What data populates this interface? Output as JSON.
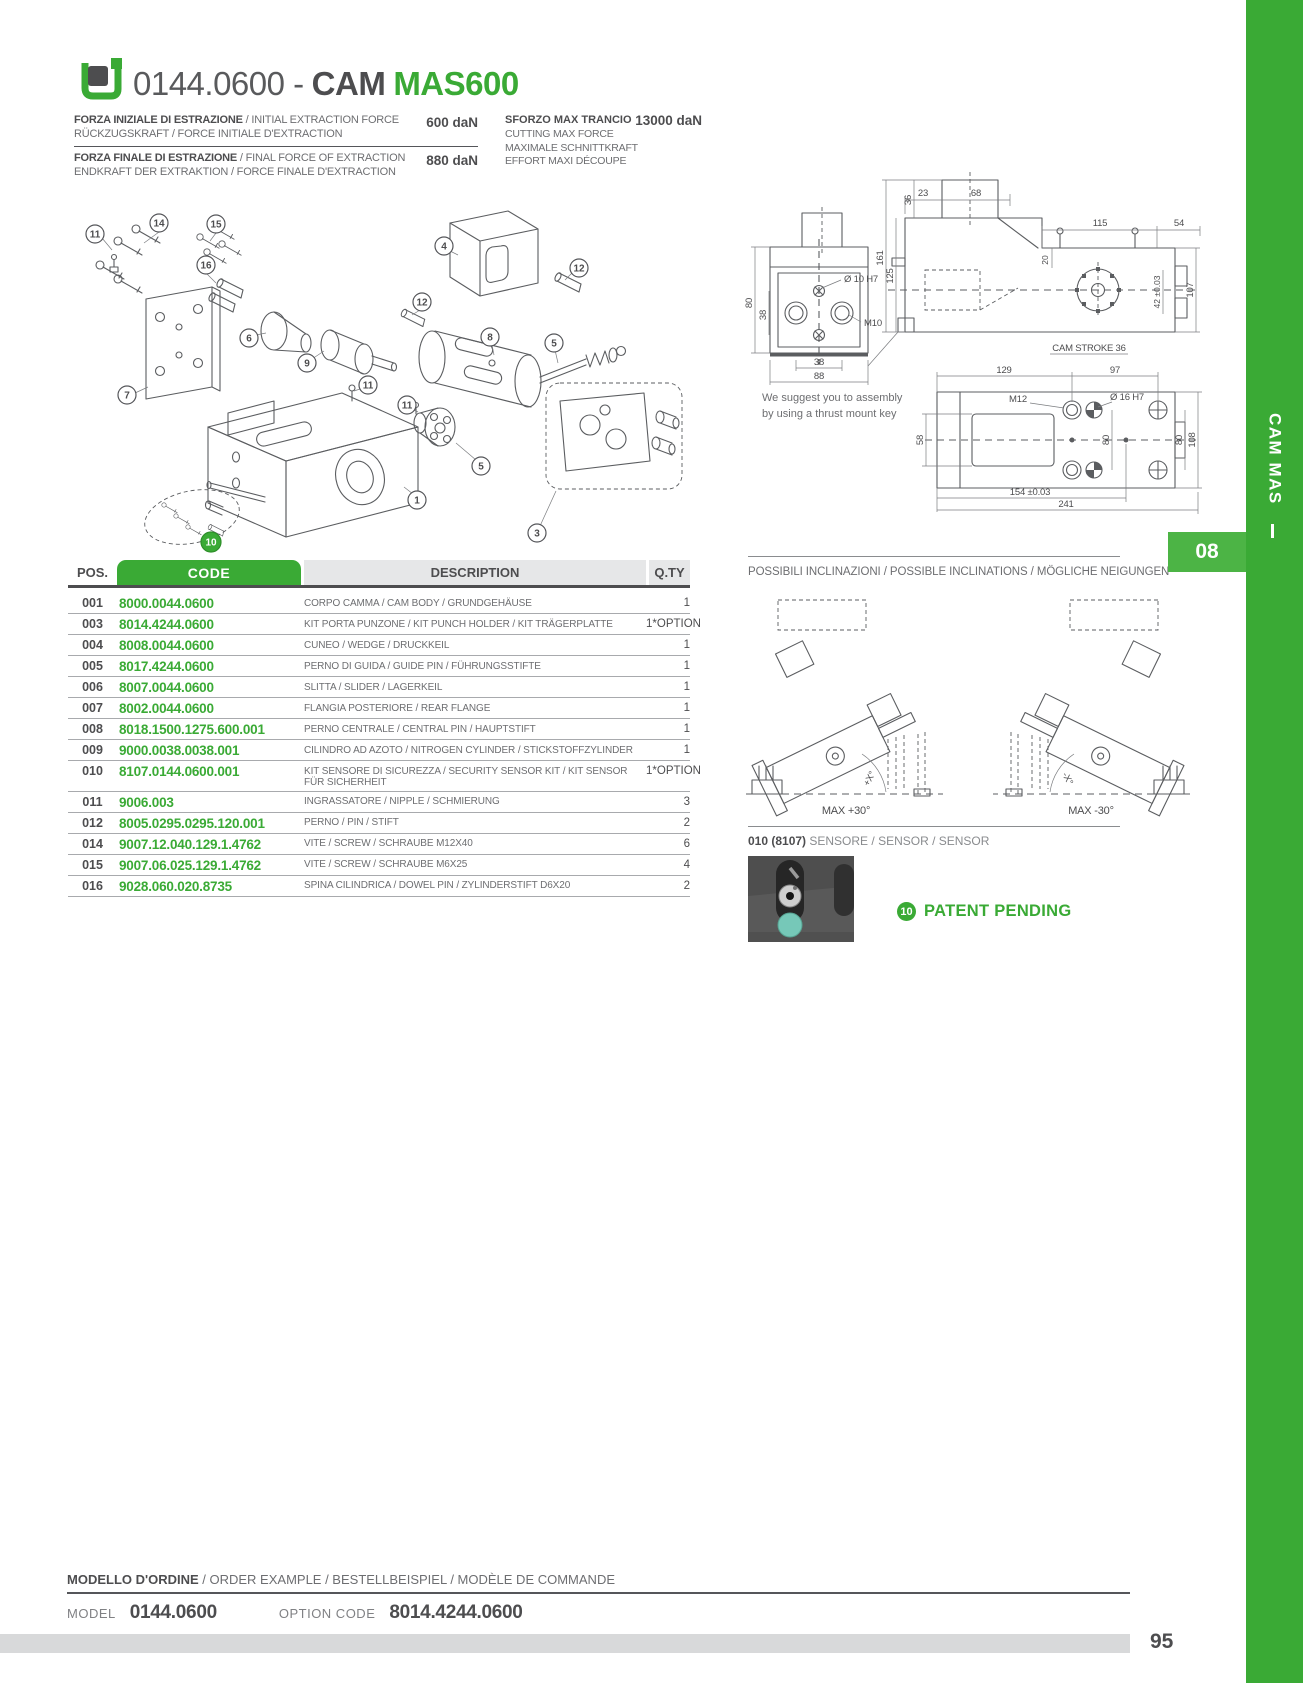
{
  "header": {
    "logo_icon": "green-bracket-logo",
    "title_prefix": "0144.0600 -",
    "title_bold": "CAM",
    "title_accent": "MAS600"
  },
  "specs": {
    "left_rows": [
      {
        "label_bold": "FORZA INIZIALE DI ESTRAZIONE",
        "label_rest": " / INITIAL EXTRACTION FORCE",
        "label_line2": "RÜCKZUGSKRAFT / FORCE INITIALE D'EXTRACTION",
        "value": "600 daN"
      },
      {
        "label_bold": "FORZA FINALE DI ESTRAZIONE",
        "label_rest": " / FINAL FORCE OF EXTRACTION",
        "label_line2": "ENDKRAFT DER EXTRAKTION / FORCE FINALE D'EXTRACTION",
        "value": "880 daN"
      }
    ],
    "right": {
      "label_bold": "SFORZO MAX TRANCIO",
      "value": "13000 daN",
      "lines": [
        "CUTTING MAX FORCE",
        "MAXIMALE SCHNITTKRAFT",
        "EFFORT MAXI DÉCOUPE"
      ]
    }
  },
  "exploded": {
    "balloons": [
      "11",
      "14",
      "15",
      "16",
      "6",
      "9",
      "7",
      "4",
      "12",
      "12",
      "8",
      "5",
      "11",
      "11",
      "5",
      "1",
      "3"
    ],
    "green_balloon": "10"
  },
  "drawings": {
    "note1": "We suggest you to assembly",
    "note2": "by using a thrust mount key",
    "front": {
      "height": "80",
      "holes_v": "38",
      "holes_h": "38",
      "width": "88",
      "hole_label": "Ø 10 H7",
      "thread_label": "M10"
    },
    "side": {
      "d23": "23",
      "d68": "68",
      "d36": "36",
      "d161": "161",
      "d125": "125",
      "d115": "115",
      "d54": "54",
      "d20": "20",
      "d42": "42 ±0.03",
      "d107": "107",
      "stroke": "CAM STROKE 36"
    },
    "bottom": {
      "d129": "129",
      "d97": "97",
      "m12": "M12",
      "hole": "Ø 16 H7",
      "d58": "58",
      "d80_inner": "80",
      "d80_right": "80",
      "d108": "108",
      "d154": "154 ±0.03",
      "d241": "241"
    }
  },
  "table": {
    "headers": {
      "pos": "POS.",
      "code": "CODE",
      "description": "DESCRIPTION",
      "qty": "Q.TY"
    },
    "rows": [
      {
        "pos": "001",
        "code": "8000.0044.0600",
        "desc": "CORPO CAMMA / CAM BODY / GRUNDGEHÄUSE",
        "qty": "1"
      },
      {
        "pos": "003",
        "code": "8014.4244.0600",
        "desc": "KIT PORTA PUNZONE / KIT PUNCH HOLDER / KIT TRÄGERPLATTE",
        "qty": "1*OPTION"
      },
      {
        "pos": "004",
        "code": "8008.0044.0600",
        "desc": "CUNEO / WEDGE / DRUCKKEIL",
        "qty": "1"
      },
      {
        "pos": "005",
        "code": "8017.4244.0600",
        "desc": "PERNO DI GUIDA / GUIDE PIN / FÜHRUNGSSTIFTE",
        "qty": "1"
      },
      {
        "pos": "006",
        "code": "8007.0044.0600",
        "desc": "SLITTA / SLIDER / LAGERKEIL",
        "qty": "1"
      },
      {
        "pos": "007",
        "code": "8002.0044.0600",
        "desc": "FLANGIA POSTERIORE / REAR FLANGE",
        "qty": "1"
      },
      {
        "pos": "008",
        "code": "8018.1500.1275.600.001",
        "desc": "PERNO CENTRALE / CENTRAL PIN / HAUPTSTIFT",
        "qty": "1"
      },
      {
        "pos": "009",
        "code": "9000.0038.0038.001",
        "desc": "CILINDRO AD AZOTO / NITROGEN CYLINDER / STICKSTOFFZYLINDER",
        "qty": "1"
      },
      {
        "pos": "010",
        "code": "8107.0144.0600.001",
        "desc": "KIT SENSORE DI SICUREZZA / SECURITY SENSOR KIT / KIT SENSOR FÜR SICHERHEIT",
        "qty": "1*OPTION"
      },
      {
        "pos": "011",
        "code": "9006.003",
        "desc": "INGRASSATORE / NIPPLE / SCHMIERUNG",
        "qty": "3"
      },
      {
        "pos": "012",
        "code": "8005.0295.0295.120.001",
        "desc": "PERNO / PIN / STIFT",
        "qty": "2"
      },
      {
        "pos": "014",
        "code": "9007.12.040.129.1.4762",
        "desc": "VITE / SCREW / SCHRAUBE M12X40",
        "qty": "6"
      },
      {
        "pos": "015",
        "code": "9007.06.025.129.1.4762",
        "desc": "VITE / SCREW / SCHRAUBE M6X25",
        "qty": "4"
      },
      {
        "pos": "016",
        "code": "9028.060.020.8735",
        "desc": "SPINA CILINDRICA / DOWEL PIN / ZYLINDERSTIFT D6X20",
        "qty": "2"
      }
    ]
  },
  "inclinations": {
    "title": "POSSIBILI INCLINAZIONI / POSSIBLE INCLINATIONS / MÖGLICHE NEIGUNGEN",
    "left_angle": "+X°",
    "right_angle": "-X°",
    "left_max": "MAX +30°",
    "right_max": "MAX -30°"
  },
  "sensor": {
    "ref": "010 (8107)",
    "label": " SENSORE / SENSOR / SENSOR"
  },
  "patent": {
    "badge": "10",
    "text": "PATENT PENDING"
  },
  "order": {
    "title_bold": "MODELLO D'ORDINE",
    "title_rest": " / ORDER EXAMPLE / BESTELLBEISPIEL / MODÈLE DE COMMANDE",
    "model_label": "MODEL",
    "model_value": "0144.0600",
    "option_label": "OPTION CODE",
    "option_value": "8014.4244.0600"
  },
  "sidebar": {
    "vertical_label": "CAM MAS",
    "chapter": "08"
  },
  "footer": {
    "page_number": "95"
  },
  "colors": {
    "accent": "#3aaa35",
    "dark": "#4d4d4f",
    "mid": "#6d6e71",
    "table_header_bg": "#e6e7e8"
  }
}
